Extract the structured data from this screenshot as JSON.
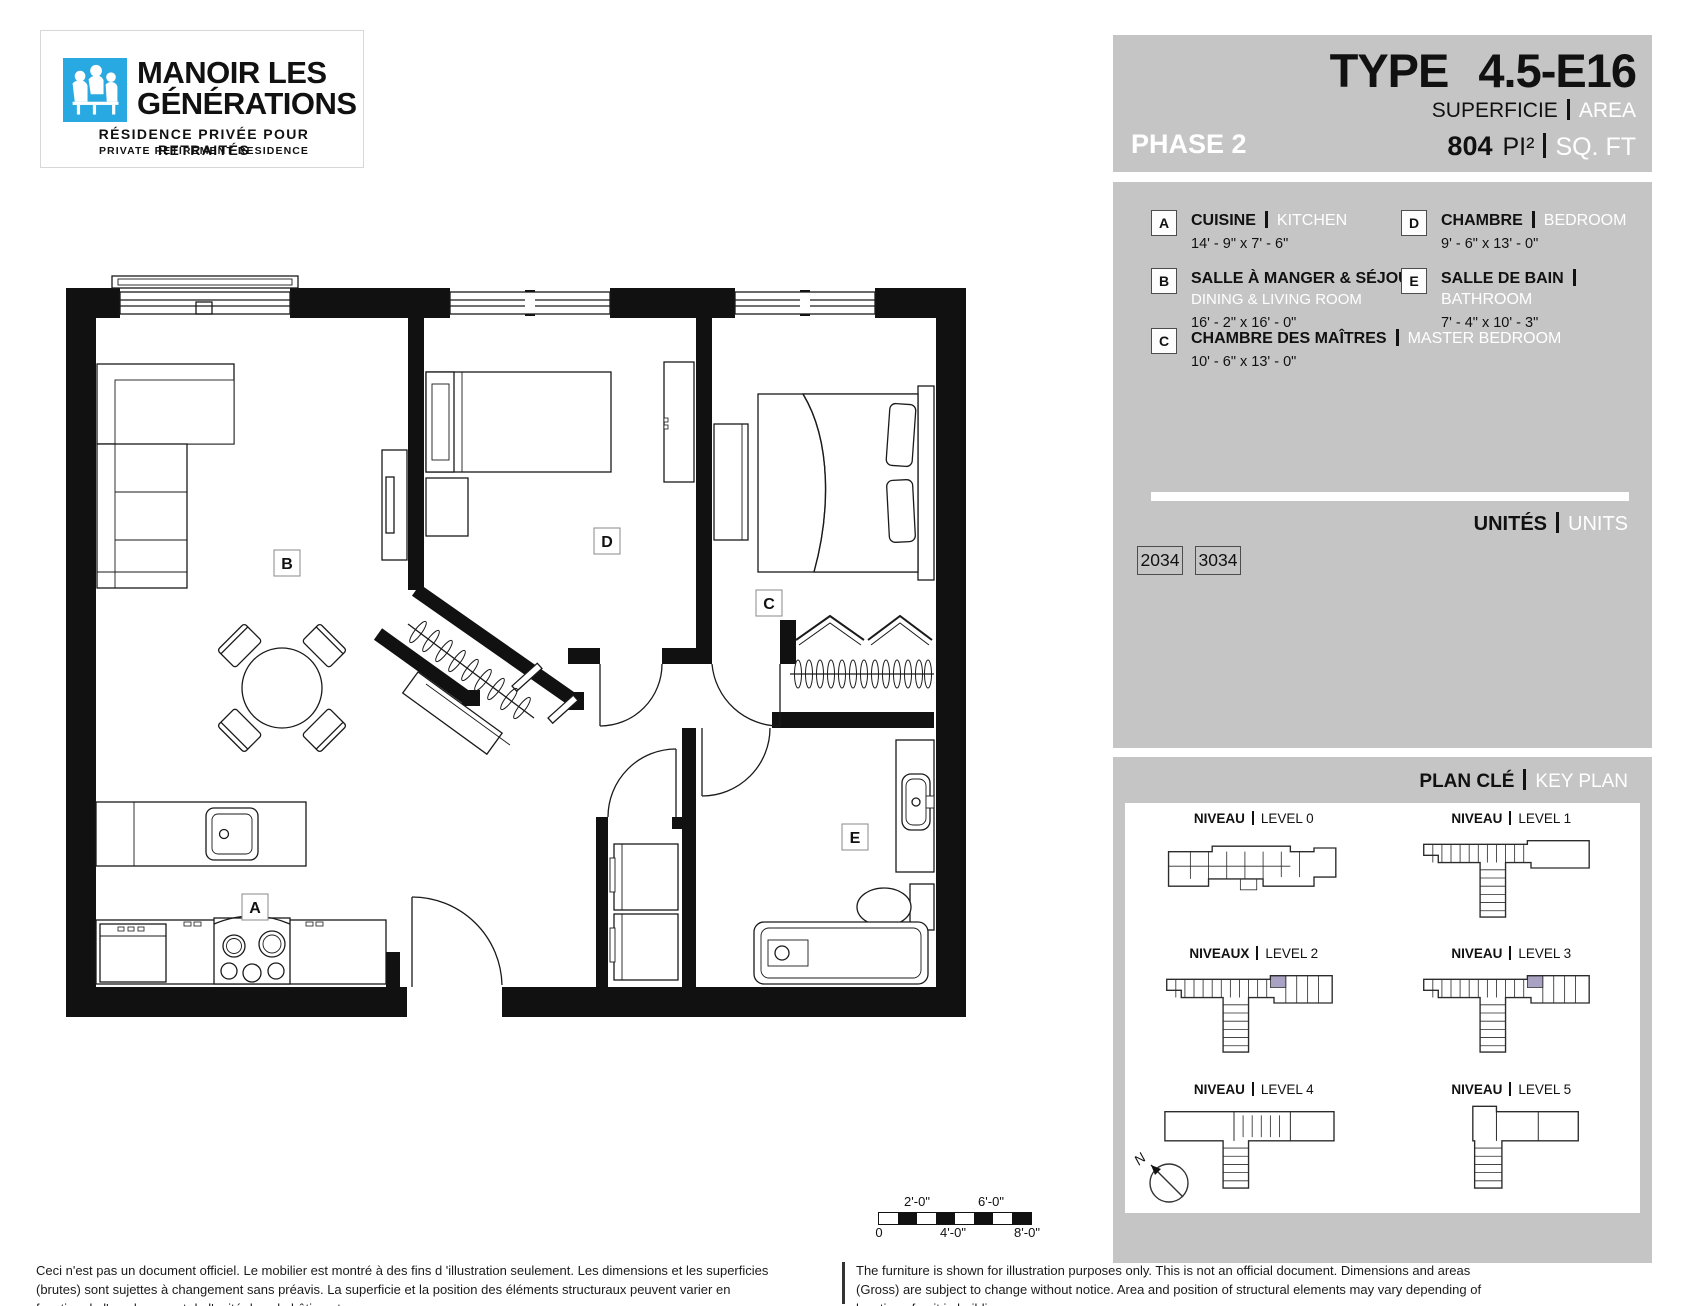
{
  "logo": {
    "title_line1": "MANOIR LES",
    "title_line2": "GÉNÉRATIONS",
    "subtitle_fr": "RÉSIDENCE PRIVÉE POUR RETRAITÉS",
    "subtitle_en": "PRIVATE RETIREMENT RESIDENCE",
    "brand_color": "#29A9E1"
  },
  "header": {
    "type_label": "TYPE",
    "type_value": "4.5-E16",
    "phase": "PHASE 2",
    "superficie_label": "SUPERFICIE",
    "area_label": "AREA",
    "area_value": "804",
    "area_unit_fr": "PI²",
    "area_unit_en": "SQ. FT"
  },
  "legend": {
    "items": [
      {
        "key": "A",
        "name_fr": "CUISINE",
        "name_en": "KITCHEN",
        "dimensions": "14' - 9\" x 7' - 6\""
      },
      {
        "key": "B",
        "name_fr": "SALLE À MANGER & SÉJOUR",
        "name_en": "DINING & LIVING ROOM",
        "dimensions": "16' - 2\" x 16' - 0\""
      },
      {
        "key": "C",
        "name_fr": "CHAMBRE DES MAÎTRES",
        "name_en": "MASTER BEDROOM",
        "dimensions": "10' - 6\" x 13' - 0\""
      },
      {
        "key": "D",
        "name_fr": "CHAMBRE",
        "name_en": "BEDROOM",
        "dimensions": "9' - 6\" x 13' - 0\""
      },
      {
        "key": "E",
        "name_fr": "SALLE DE BAIN",
        "name_en": "BATHROOM",
        "dimensions": "7' - 4\" x 10' - 3\""
      }
    ]
  },
  "units": {
    "label_fr": "UNITÉS",
    "label_en": "UNITS",
    "list": [
      "2034",
      "3034"
    ]
  },
  "key_plan": {
    "label_fr": "PLAN CLÉ",
    "label_en": "KEY PLAN",
    "highlight_color": "#A9A2C2",
    "compass": "N",
    "levels": [
      {
        "label_fr": "NIVEAU",
        "label_en": "LEVEL 0",
        "highlighted": false
      },
      {
        "label_fr": "NIVEAU",
        "label_en": "LEVEL 1",
        "highlighted": false
      },
      {
        "label_fr": "NIVEAUX",
        "label_en": "LEVEL 2",
        "highlighted": true
      },
      {
        "label_fr": "NIVEAU",
        "label_en": "LEVEL 3",
        "highlighted": true
      },
      {
        "label_fr": "NIVEAU",
        "label_en": "LEVEL 4",
        "highlighted": false
      },
      {
        "label_fr": "NIVEAU",
        "label_en": "LEVEL 5",
        "highlighted": false
      }
    ]
  },
  "floor_plan": {
    "labels": {
      "a": "A",
      "b": "B",
      "c": "C",
      "d": "D",
      "e": "E"
    }
  },
  "scale_bar": {
    "top_labels": [
      "2'-0\"",
      "6'-0\""
    ],
    "bottom_labels": [
      "0",
      "4'-0\"",
      "8'-0\""
    ]
  },
  "disclaimer": {
    "fr": "Ceci n'est pas un document officiel.  Le mobilier est montré à des fins d 'illustration seulement.  Les dimensions et les superficies (brutes) sont sujettes à changement sans préavis. La superficie et la position des éléments structuraux peuvent varier en fonction de l'emplacement de l'unité dans le bâtiment.",
    "en": "The furniture is shown for illustration purposes only.  This is not an official document.  Dimensions and areas (Gross) are subject to change without notice. Area and position of structural elements may vary depending of location of unit in building."
  }
}
